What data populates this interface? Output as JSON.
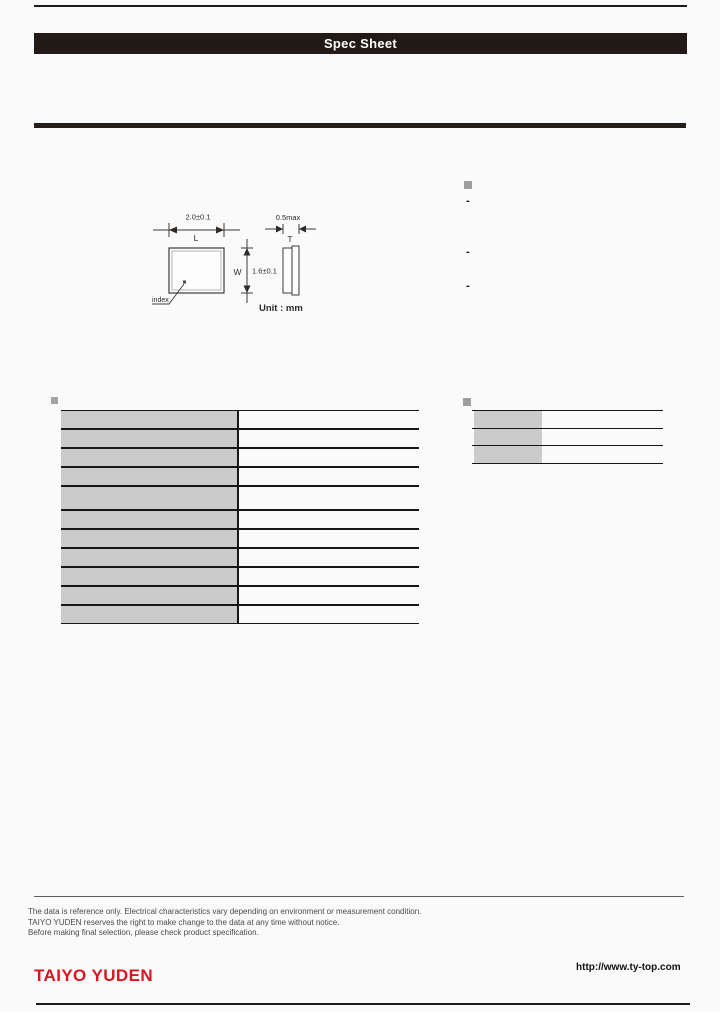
{
  "header": {
    "title": "Spec Sheet"
  },
  "drawing": {
    "length_dim": "2.0±0.1",
    "length_label": "L",
    "width_label": "W",
    "width_dim": "1.6±0.1",
    "thickness_dim": "0.5max",
    "thickness_label": "T",
    "index_label": "index",
    "unit": "Unit : mm"
  },
  "features": {
    "items": [
      "-",
      "-",
      "-"
    ]
  },
  "left_table": {
    "rows": [
      {
        "label": "",
        "value": ""
      },
      {
        "label": "",
        "value": ""
      },
      {
        "label": "",
        "value": ""
      },
      {
        "label": "",
        "value": ""
      },
      {
        "label": "",
        "value": ""
      },
      {
        "label": "",
        "value": ""
      },
      {
        "label": "",
        "value": ""
      },
      {
        "label": "",
        "value": ""
      },
      {
        "label": "",
        "value": ""
      },
      {
        "label": "",
        "value": ""
      },
      {
        "label": "",
        "value": ""
      }
    ]
  },
  "right_table": {
    "rows": [
      {
        "label": "",
        "value": ""
      },
      {
        "label": "",
        "value": ""
      },
      {
        "label": "",
        "value": ""
      }
    ]
  },
  "notes": {
    "lines": [
      "The data is reference only. Electrical characteristics vary depending on environment or measurement condition.",
      "TAIYO YUDEN reserves the right to make change to the data at any time without notice.",
      "Before making final selection, please check product specification."
    ]
  },
  "footer": {
    "logo": "TAIYO YUDEN",
    "url": "http://www.ty-top.com"
  },
  "colors": {
    "accent_red": "#d81522",
    "bar_black": "#211a16",
    "table_gray": "#cbcbcb",
    "bullet_gray": "#9e9e9e"
  }
}
